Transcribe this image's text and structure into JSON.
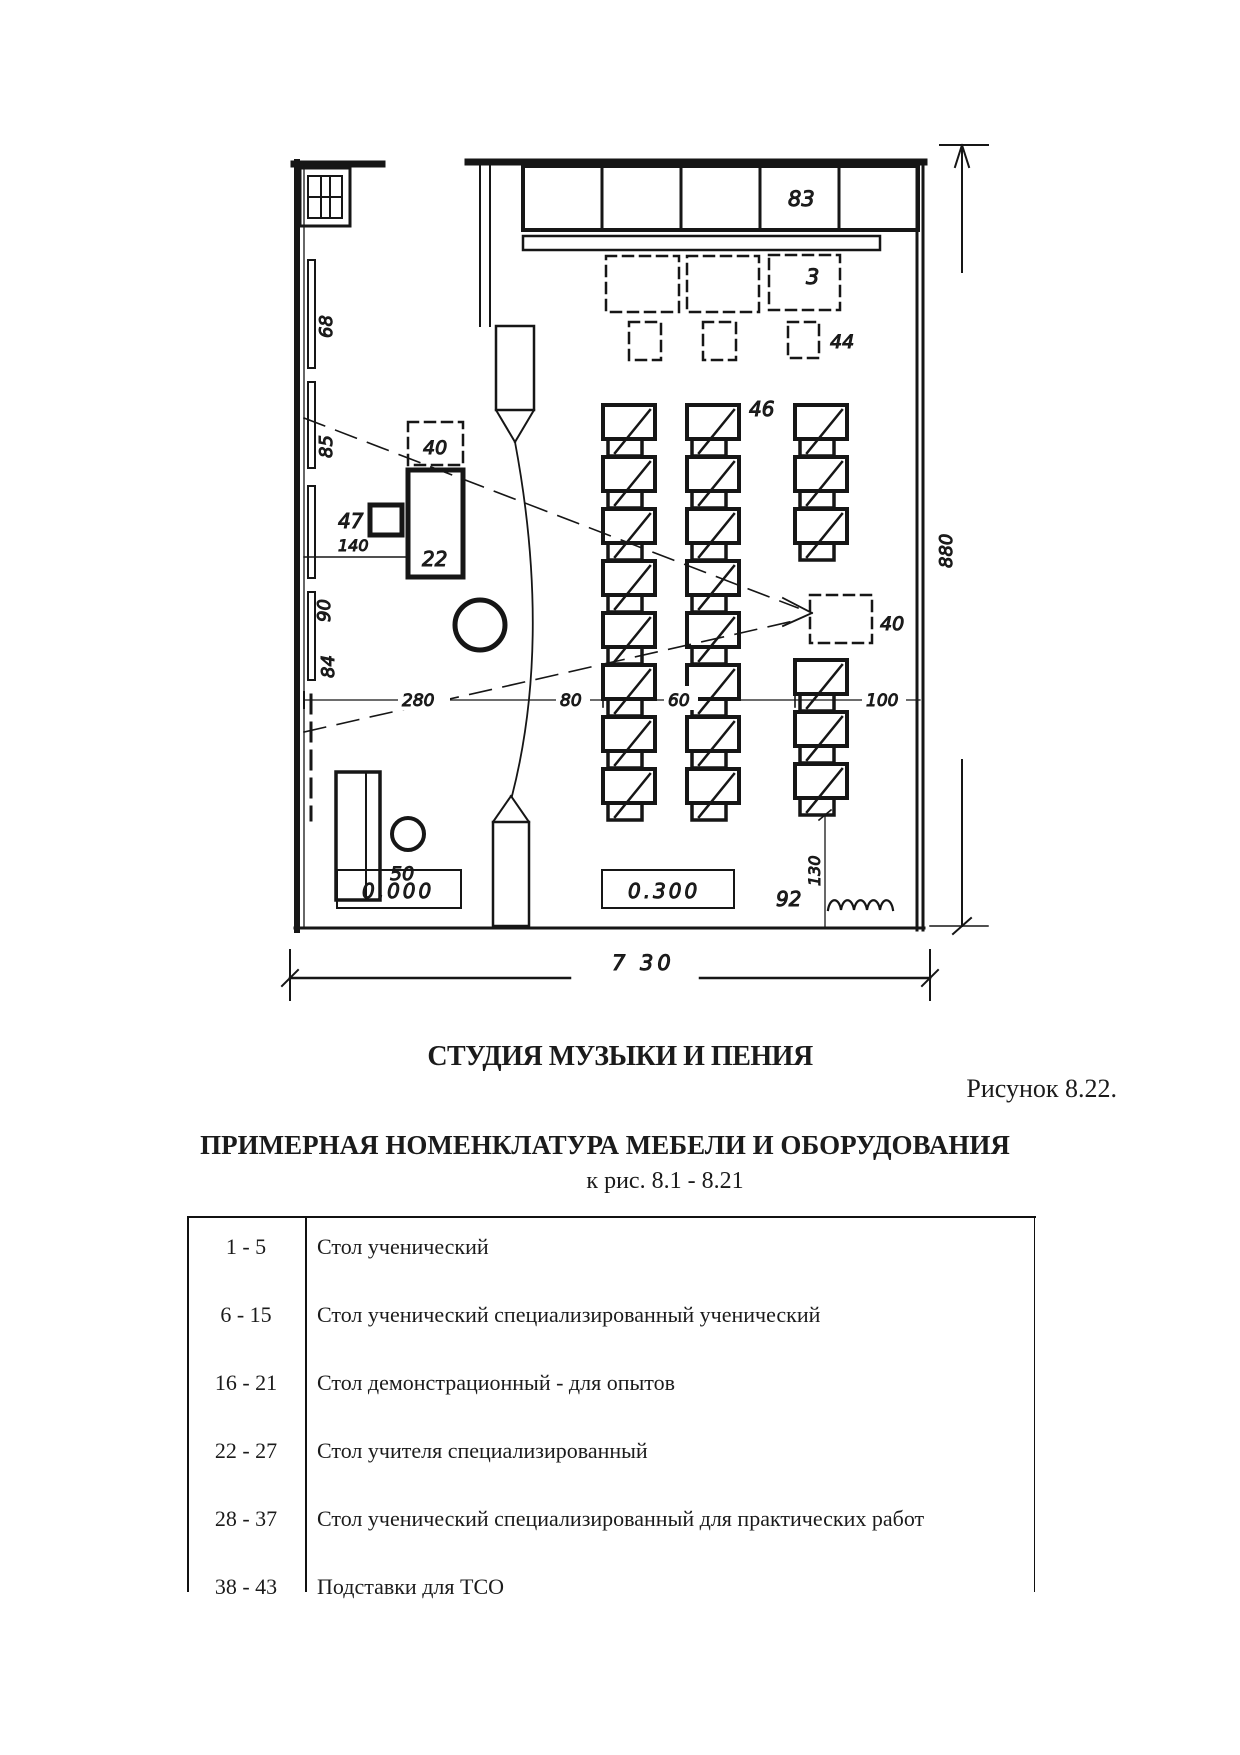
{
  "page": {
    "figure_title": "СТУДИЯ МУЗЫКИ И ПЕНИЯ",
    "figure_caption": "Рисунок 8.22.",
    "table_title": "ПРИМЕРНАЯ НОМЕНКЛАТУРА МЕБЕЛИ И ОБОРУДОВАНИЯ",
    "table_subtitle": "к рис. 8.1 - 8.21"
  },
  "plan": {
    "labels": {
      "cabinet_83": "83",
      "dashed_rect_3": "3",
      "small_square_44": "44",
      "board_68": "68",
      "board_85": "85",
      "board_90": "90",
      "board_84": "84",
      "stand_40_left": "40",
      "square_47": "47",
      "dim_140": "140",
      "teacher_table_22": "22",
      "desks_46": "46",
      "stand_40_right": "40",
      "dim_280": "280",
      "dim_80": "80",
      "dim_60": "60",
      "dim_100": "100",
      "piano_stool_50": "50",
      "level_zero": "0,000",
      "level_300": "0.300",
      "curtain_92": "92",
      "dim_130": "130",
      "dim_width_730": "7 30",
      "dim_height_880": "880"
    }
  },
  "table": {
    "rows": [
      {
        "range": "1 - 5",
        "name": "Стол ученический"
      },
      {
        "range": "6 - 15",
        "name": "Стол ученический специализированный ученический"
      },
      {
        "range": "16 - 21",
        "name": "Стол демонстрационный - для опытов"
      },
      {
        "range": "22 - 27",
        "name": "Стол учителя специализированный"
      },
      {
        "range": "28 - 37",
        "name": "Стол ученический специализированный для практических работ"
      },
      {
        "range": "38 - 43",
        "name": "Подставки для ТСО"
      }
    ]
  }
}
